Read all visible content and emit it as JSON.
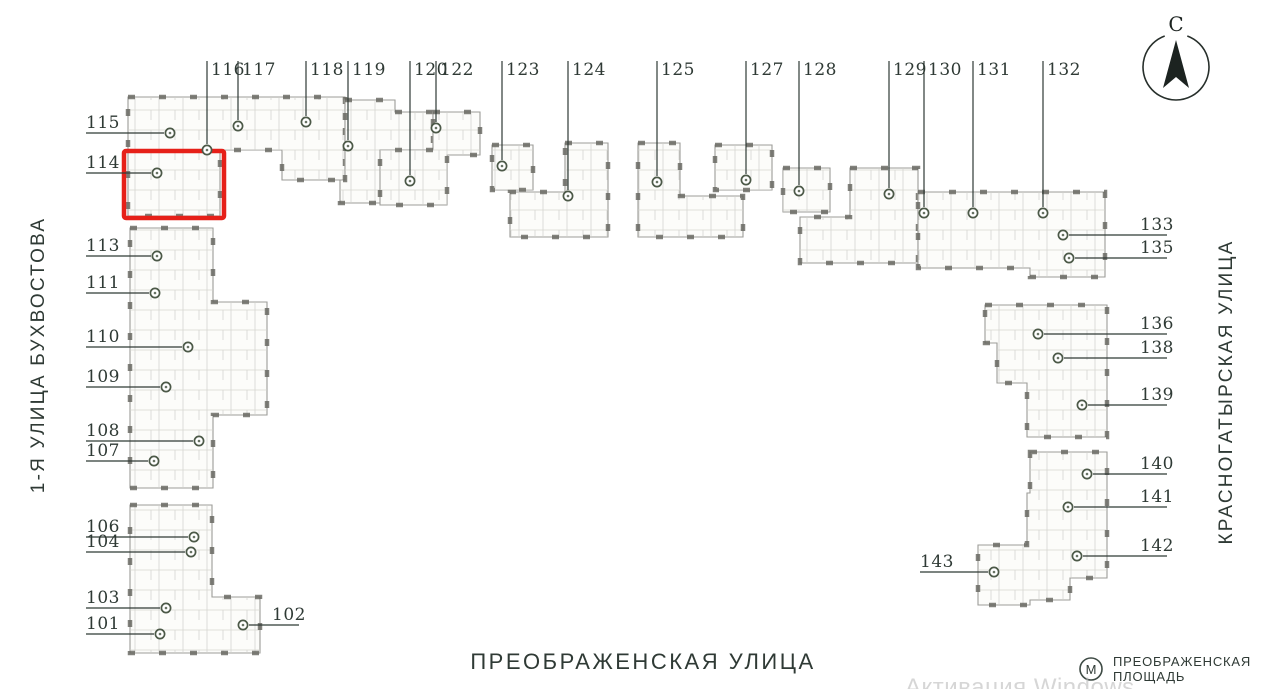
{
  "canvas": {
    "width": 1261,
    "height": 689
  },
  "colors": {
    "accent_red": "#e62019",
    "ink": "#2f3a35",
    "plan_stroke": "#9c9c98",
    "plan_wall": "#63635d",
    "marker_ring": "#4c5948",
    "watermark_gray": "#bcbcbc"
  },
  "compass": {
    "letter": "С"
  },
  "streets": {
    "left": "1-Я УЛИЦА БУХВОСТОВА",
    "right": "КРАСНОГАТЫРСКАЯ УЛИЦА",
    "bottom": "ПРЕОБРАЖЕНСКАЯ УЛИЦА"
  },
  "metro": {
    "icon_letter": "М",
    "label_line1": "ПРЕОБРАЖЕНСКАЯ",
    "label_line2": "ПЛОЩАДЬ"
  },
  "watermark": {
    "text": "Активация Windows"
  },
  "highlight": {
    "unit": "114",
    "x": 124,
    "y": 151,
    "width": 100,
    "height": 67
  },
  "buildings": [
    {
      "id": "bldg-114-117",
      "points": "128,97 345,97 345,180 282,180 282,150 220,150 220,216 128,216"
    },
    {
      "id": "bldg-118-119",
      "points": "345,100 395,100 395,112 433,112 433,150 420,150 420,203 340,203 340,180 345,180"
    },
    {
      "id": "bldg-120-122",
      "points": "433,112 480,112 480,155 447,155 447,205 380,205 380,150 433,150"
    },
    {
      "id": "bldg-123",
      "points": "492,145 533,145 533,190 492,190"
    },
    {
      "id": "bldg-124",
      "points": "565,143 608,143 608,237 510,237 510,192 565,192"
    },
    {
      "id": "bldg-125",
      "points": "638,143 680,143 680,196 743,196 743,237 638,237"
    },
    {
      "id": "bldg-127",
      "points": "715,145 772,145 772,190 715,190"
    },
    {
      "id": "bldg-128",
      "points": "783,168 830,168 830,212 783,212"
    },
    {
      "id": "bldg-129",
      "points": "850,168 918,168 918,263 800,263 800,217 850,217"
    },
    {
      "id": "bldg-130-135",
      "points": "918,192 1105,192 1105,277 1030,277 1030,268 918,268"
    },
    {
      "id": "bldg-136-139",
      "points": "985,305 1107,305 1107,437 1027,437 1027,383 997,383 997,343 985,343"
    },
    {
      "id": "bldg-140-143",
      "points": "1030,452 1107,452 1107,578 1070,578 1070,600 1030,600 1030,605 978,605 978,545 1027,545 1027,493 1030,493"
    },
    {
      "id": "bldg-107-113",
      "points": "130,228 213,228 213,302 267,302 267,415 213,415 213,488 130,488"
    },
    {
      "id": "bldg-101-106",
      "points": "130,505 212,505 212,597 260,597 260,653 130,653"
    }
  ],
  "units": [
    {
      "label": "101",
      "side": "left",
      "mx": 160,
      "my": 634
    },
    {
      "label": "102",
      "side": "right",
      "mx": 243,
      "my": 625,
      "tx": 272
    },
    {
      "label": "103",
      "side": "left",
      "mx": 166,
      "my": 608
    },
    {
      "label": "104",
      "side": "left",
      "mx": 191,
      "my": 552
    },
    {
      "label": "106",
      "side": "left",
      "mx": 194,
      "my": 537
    },
    {
      "label": "107",
      "side": "left",
      "mx": 154,
      "my": 461
    },
    {
      "label": "108",
      "side": "left",
      "mx": 199,
      "my": 441
    },
    {
      "label": "109",
      "side": "left",
      "mx": 166,
      "my": 387
    },
    {
      "label": "110",
      "side": "left",
      "mx": 188,
      "my": 347
    },
    {
      "label": "111",
      "side": "left",
      "mx": 155,
      "my": 293
    },
    {
      "label": "113",
      "side": "left",
      "mx": 157,
      "my": 256
    },
    {
      "label": "114",
      "side": "left",
      "mx": 157,
      "my": 173
    },
    {
      "label": "115",
      "side": "left",
      "mx": 170,
      "my": 133
    },
    {
      "label": "116",
      "side": "top",
      "mx": 207,
      "my": 150
    },
    {
      "label": "117",
      "side": "top",
      "mx": 238,
      "my": 126
    },
    {
      "label": "118",
      "side": "top",
      "mx": 306,
      "my": 122
    },
    {
      "label": "119",
      "side": "top",
      "mx": 348,
      "my": 146
    },
    {
      "label": "120",
      "side": "top",
      "mx": 410,
      "my": 181
    },
    {
      "label": "122",
      "side": "top",
      "mx": 436,
      "my": 128
    },
    {
      "label": "123",
      "side": "top",
      "mx": 502,
      "my": 166
    },
    {
      "label": "124",
      "side": "top",
      "mx": 568,
      "my": 196
    },
    {
      "label": "125",
      "side": "top",
      "mx": 657,
      "my": 182
    },
    {
      "label": "127",
      "side": "top",
      "mx": 746,
      "my": 180
    },
    {
      "label": "128",
      "side": "top",
      "mx": 799,
      "my": 191
    },
    {
      "label": "129",
      "side": "top",
      "mx": 889,
      "my": 194
    },
    {
      "label": "130",
      "side": "top",
      "mx": 924,
      "my": 213
    },
    {
      "label": "131",
      "side": "top",
      "mx": 973,
      "my": 213
    },
    {
      "label": "132",
      "side": "top",
      "mx": 1043,
      "my": 213
    },
    {
      "label": "133",
      "side": "right",
      "mx": 1063,
      "my": 235
    },
    {
      "label": "135",
      "side": "right",
      "mx": 1069,
      "my": 258
    },
    {
      "label": "136",
      "side": "right",
      "mx": 1038,
      "my": 334
    },
    {
      "label": "138",
      "side": "right",
      "mx": 1058,
      "my": 358
    },
    {
      "label": "139",
      "side": "right",
      "mx": 1082,
      "my": 405
    },
    {
      "label": "140",
      "side": "right",
      "mx": 1087,
      "my": 474
    },
    {
      "label": "141",
      "side": "right",
      "mx": 1068,
      "my": 507
    },
    {
      "label": "142",
      "side": "right",
      "mx": 1077,
      "my": 556
    },
    {
      "label": "143",
      "side": "left",
      "mx": 994,
      "my": 572,
      "tx": 920
    }
  ]
}
